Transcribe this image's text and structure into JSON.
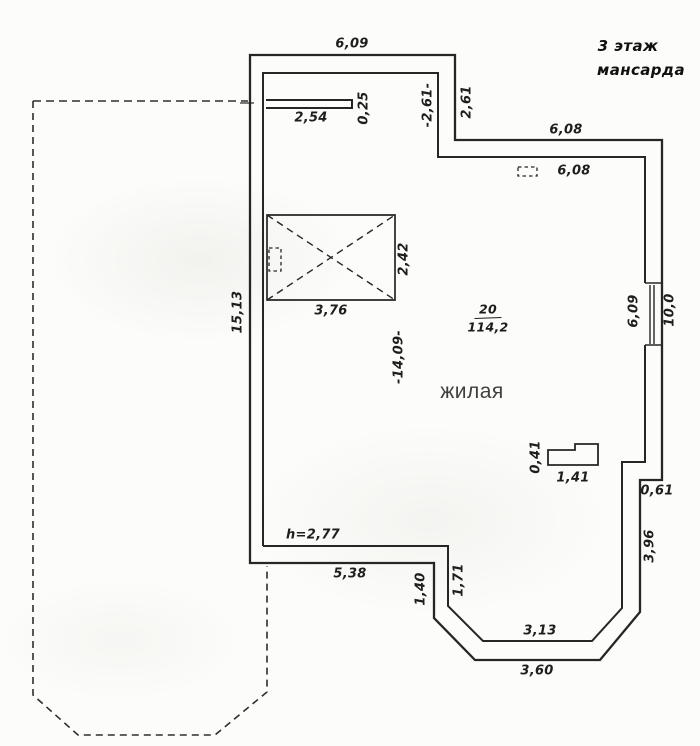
{
  "title": {
    "floor": "3 этаж",
    "type": "мансарда"
  },
  "room": {
    "number": "20",
    "area": "114,2",
    "name": "жилая"
  },
  "dims": {
    "top_wall": "6,09",
    "stub_length": "2,54",
    "stub_thickness": "0,25",
    "notch_left": "-2,61-",
    "notch_right": "2,61",
    "upper_wall_outer": "6,08",
    "upper_wall_inner": "6,08",
    "opening_width": "3,76",
    "opening_height": "2,42",
    "left_wall": "15,13",
    "room_width": "-14,09-",
    "window_left": "6,09",
    "window_right": "10,0",
    "duct_height": "0,41",
    "duct_width": "1,41",
    "wall_step": "0,61",
    "right_lower_wall": "3,96",
    "ceiling_height": "h=2,77",
    "bottom_inner_wall": "5,38",
    "bay_left_vertical": "1,40",
    "bay_left_diagonal": "1,71",
    "bay_bottom_inner": "3,13",
    "bay_bottom_outer": "3,60"
  },
  "colors": {
    "line": "#262626",
    "dashed_line": "#2e2e2e",
    "dim_text": "#1e1e1e",
    "room_name_text": "#3f3f3f",
    "background": "#fcfcfa"
  }
}
